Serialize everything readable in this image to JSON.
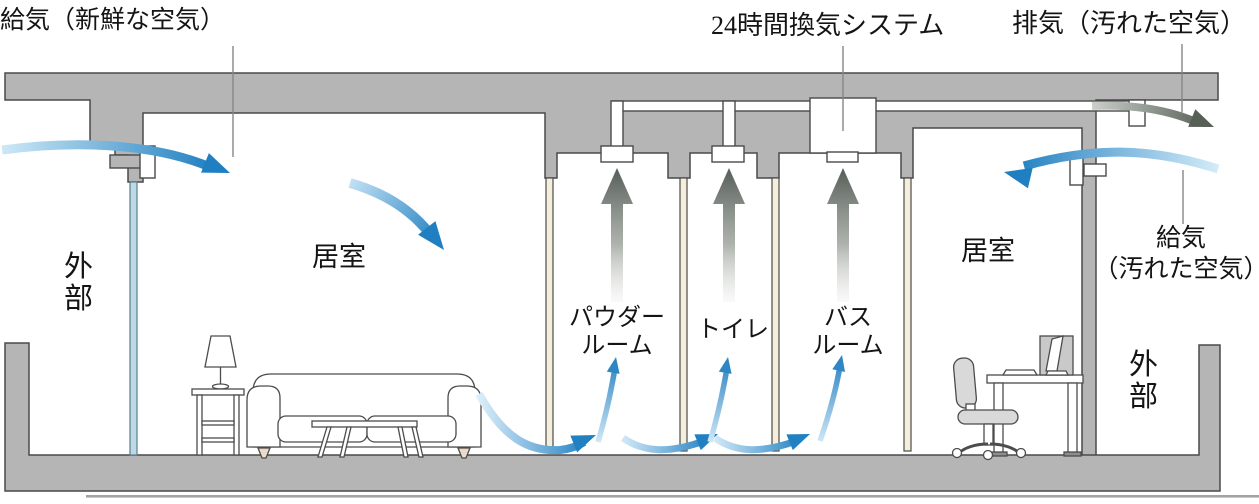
{
  "diagram_title": "24時間換気システム",
  "labels": {
    "supply_fresh": "給気（新鮮な空気）",
    "system": "24時間換気システム",
    "exhaust_dirty": "排気（汚れた空気）",
    "supply_dirty": "給気\n（汚れた空気）",
    "living_left": "居室",
    "living_right": "居室",
    "exterior_left": "外部",
    "exterior_right": "外部",
    "powder_room": "パウダー\nルーム",
    "toilet": "トイレ",
    "bath_room": "バス\nルーム"
  },
  "colors": {
    "structure_gray": "#b5b5b5",
    "outline": "#4a4a4a",
    "wall_beige": "#f4eedb",
    "wall_light_blue": "#bcd9e5",
    "supply_air_blue": "#1f7fc0",
    "supply_air_blue_light": "#cfe9f7",
    "exhaust_air_gray": "#58605a",
    "pointer_line": "#868686"
  }
}
